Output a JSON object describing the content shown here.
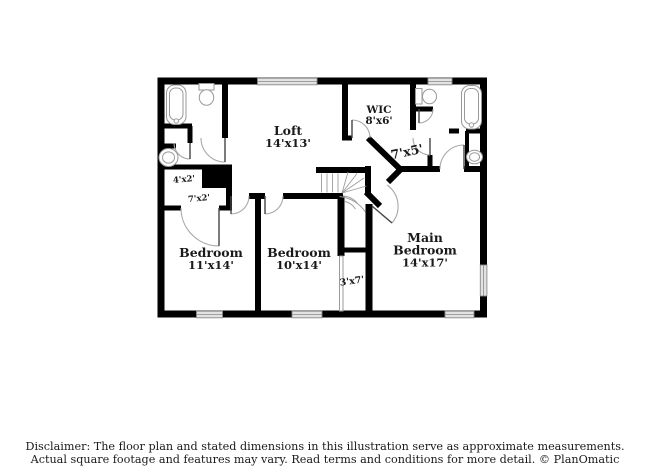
{
  "page": {
    "background": "#ffffff"
  },
  "colors": {
    "wall": "#000000",
    "line": "#9a9a9a",
    "door": "#444444",
    "window-fill": "#e2e2e2",
    "ink": "#1a1a1a",
    "bg": "#ffffff"
  },
  "floor_plan": {
    "labels": {
      "loft": {
        "name": "Loft",
        "dims": "14'x13'"
      },
      "wic": {
        "name": "WIC",
        "dims": "8'x6'"
      },
      "hall_7x5": {
        "dims": "7'x5'"
      },
      "closet_4x2": {
        "dims": "4'x2'"
      },
      "hall_7x2": {
        "dims": "7'x2'"
      },
      "bedroom_left": {
        "name": "Bedroom",
        "dims": "11'x14'"
      },
      "bedroom_middle": {
        "name": "Bedroom",
        "dims": "10'x14'"
      },
      "closet_3x7": {
        "dims": "3'x7'"
      },
      "main_bedroom": {
        "name_line1": "Main",
        "name_line2": "Bedroom",
        "dims": "14'x17'"
      }
    }
  },
  "disclaimer": {
    "line1": "Disclaimer: The floor plan and stated dimensions in this illustration serve as approximate measurements.",
    "line2": "Actual square footage and features may vary. Read terms and conditions for more detail. © PlanOmatic"
  }
}
